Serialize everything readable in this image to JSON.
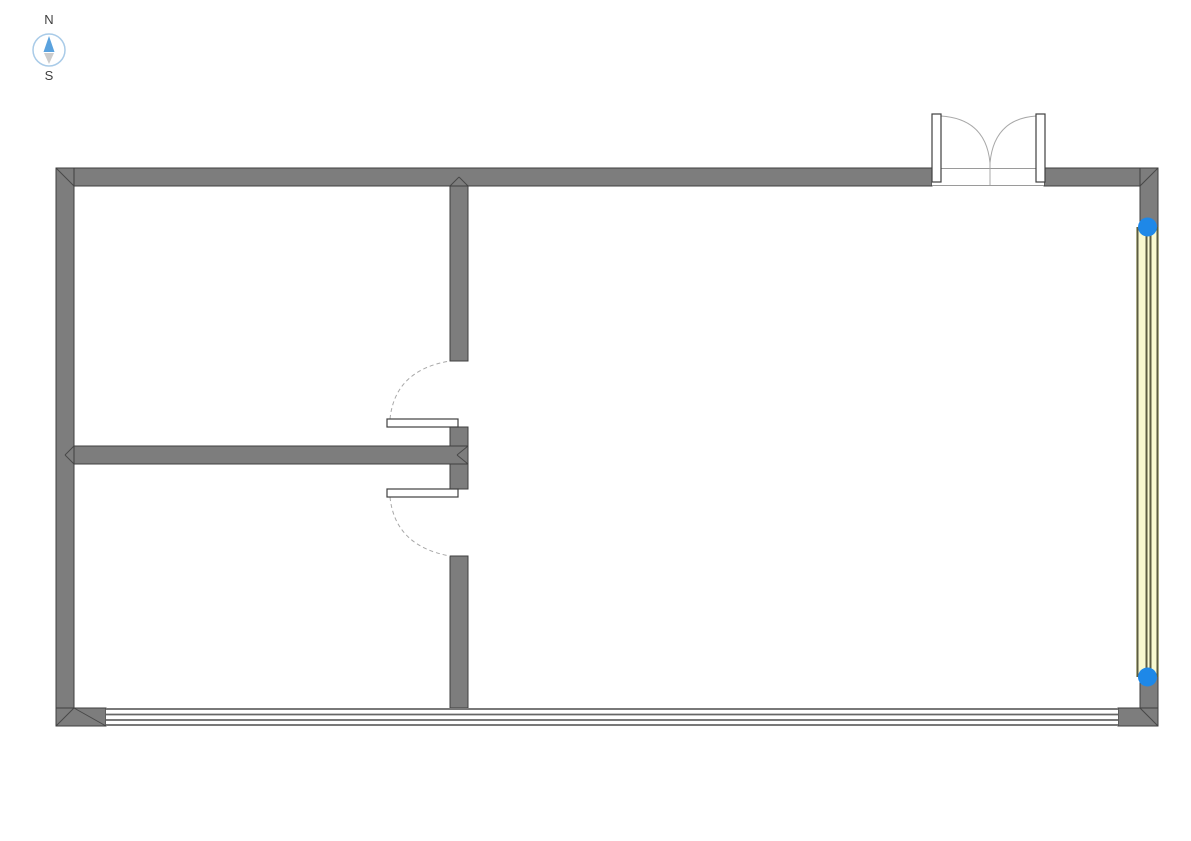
{
  "compass": {
    "north_label": "N",
    "south_label": "S"
  },
  "colors": {
    "background": "#ffffff",
    "wall": "#7d7d7d",
    "wall_outline": "#3f3f3f",
    "window_line": "#666666",
    "opening_line": "#9a9a9a",
    "swing_arc": "#a8a8a8",
    "selected_window_fill": "#f8f8d0",
    "selected_window_line": "#5c5c42",
    "selection_handle": "#1e88e8",
    "compass_north": "#5aa2de",
    "compass_south": "#cccccc",
    "compass_ring": "#a9cbe8",
    "compass_label": "#3f3f3f"
  }
}
